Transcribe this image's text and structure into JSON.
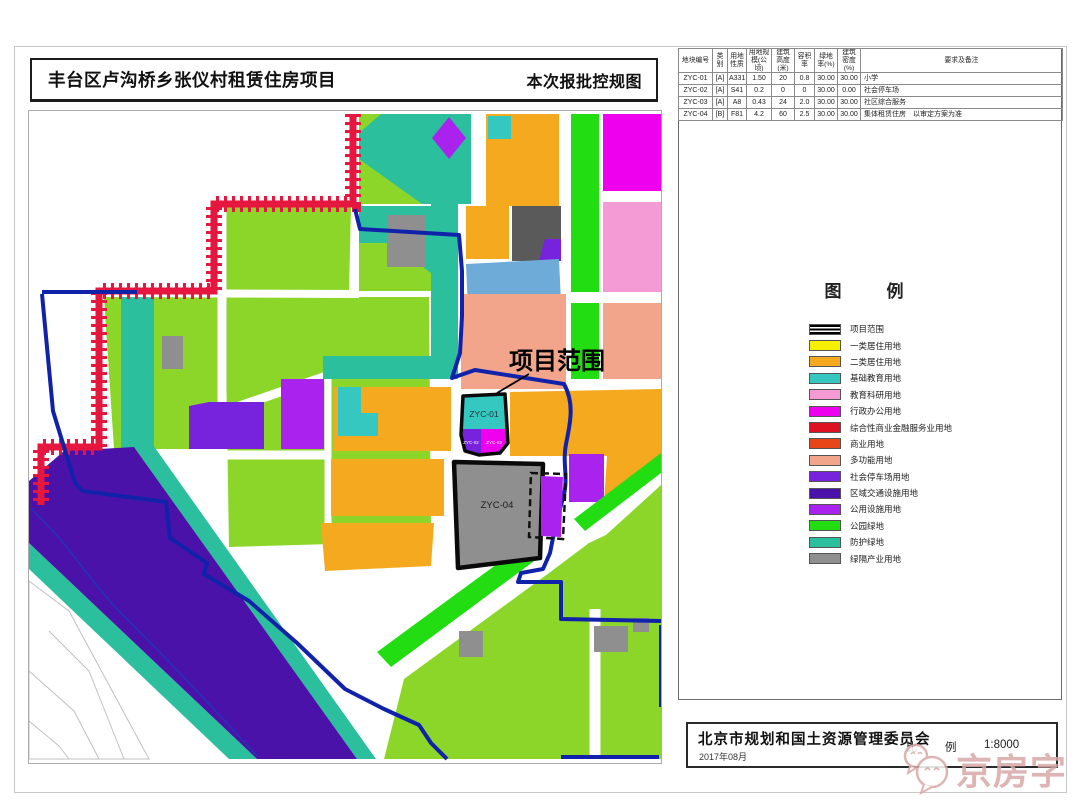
{
  "titles": {
    "project": "丰台区卢沟桥乡张仪村租赁住房项目",
    "sheet": "本次报批控规图"
  },
  "table": {
    "headers": [
      "地块编号",
      "类别",
      "用地性质",
      "用地规模(公顷)",
      "建筑高度(米)",
      "容积率",
      "绿地率(%)",
      "建筑密度(%)",
      "要求及备注"
    ],
    "rows": [
      [
        "ZYC-01",
        "[A]",
        "A331",
        "1.50",
        "20",
        "0.8",
        "30.00",
        "30.00",
        "小学"
      ],
      [
        "ZYC-02",
        "[A]",
        "S41",
        "0.2",
        "0",
        "0",
        "30.00",
        "0.00",
        "社会停车场"
      ],
      [
        "ZYC-03",
        "[A]",
        "A8",
        "0.43",
        "24",
        "2.0",
        "30.00",
        "30.00",
        "社区综合服务"
      ],
      [
        "ZYC-04",
        "[B]",
        "F81",
        "4.2",
        "60",
        "2.5",
        "30.00",
        "30.00",
        "集体租赁住房　以审定方案为准"
      ]
    ]
  },
  "legend": {
    "title": "图　例",
    "items": [
      {
        "label": "项目范围",
        "type": "outline",
        "color": "#000000"
      },
      {
        "label": "一类居住用地",
        "type": "fill",
        "color": "#F5F000"
      },
      {
        "label": "二类居住用地",
        "type": "fill",
        "color": "#F5A91F"
      },
      {
        "label": "基础教育用地",
        "type": "fill",
        "color": "#35C8C0"
      },
      {
        "label": "教育科研用地",
        "type": "fill",
        "color": "#F49AD4"
      },
      {
        "label": "行政办公用地",
        "type": "fill",
        "color": "#EE00EE"
      },
      {
        "label": "综合性商业金融服务业用地",
        "type": "fill",
        "color": "#DD1122"
      },
      {
        "label": "商业用地",
        "type": "fill",
        "color": "#E84518"
      },
      {
        "label": "多功能用地",
        "type": "fill",
        "color": "#F2A58B"
      },
      {
        "label": "社会停车场用地",
        "type": "fill",
        "color": "#7722DD"
      },
      {
        "label": "区域交通设施用地",
        "type": "fill",
        "color": "#4A12A8"
      },
      {
        "label": "公用设施用地",
        "type": "fill",
        "color": "#AA22EE"
      },
      {
        "label": "公园绿地",
        "type": "fill",
        "color": "#22DD11"
      },
      {
        "label": "防护绿地",
        "type": "fill",
        "color": "#2BBF9E"
      },
      {
        "label": "绿隔产业用地",
        "type": "fill",
        "color": "#8F8F8F"
      }
    ]
  },
  "map": {
    "scope_label": "项目范围",
    "plot1": "ZYC-01",
    "plot2": "ZYC-02",
    "plot3": "ZYC-03",
    "plot4": "ZYC-04"
  },
  "signature": {
    "agency": "北京市规划和国土资源管理委员会",
    "date": "2017年08月",
    "scale_label": "比　例",
    "scale_value": "1:8000"
  },
  "watermark": {
    "text": "京房字"
  }
}
